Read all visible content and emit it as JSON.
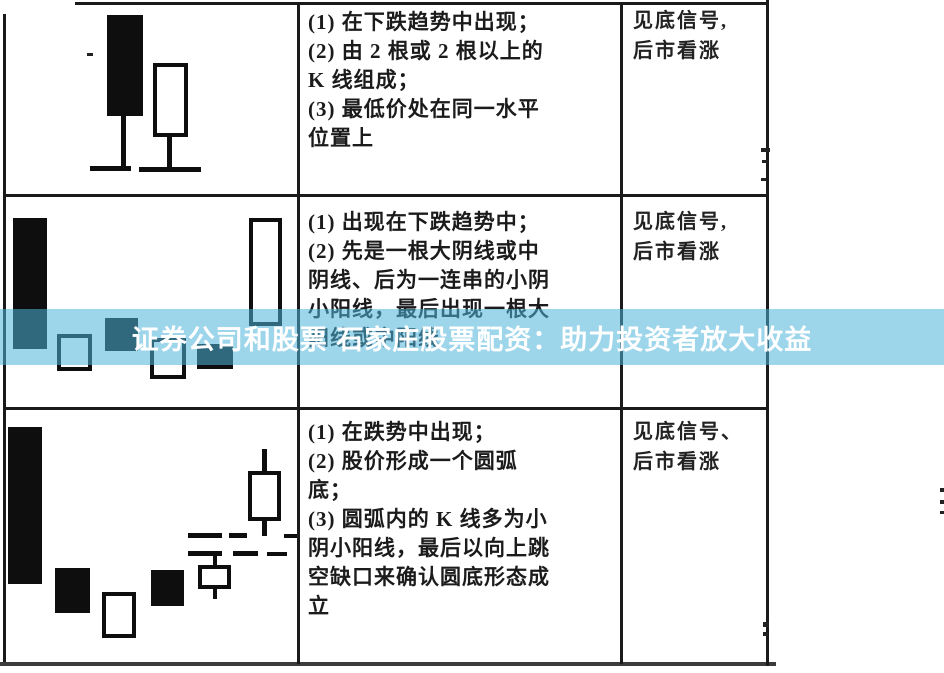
{
  "banner": {
    "text": "证券公司和股票 石家庄股票配资：助力投资者放大收益",
    "background": "rgba(77,178,218,0.55)",
    "color": "#ffffff"
  },
  "table": {
    "columns": [
      "pattern-drawing",
      "pattern-description",
      "signal"
    ],
    "rows": [
      {
        "description_lines": [
          "(1) 在下跌趋势中出现；",
          "(2) 由 2 根或 2 根以上的",
          "K 线组成；",
          "(3) 最低价处在同一水平",
          "位置上"
        ],
        "signal_lines": [
          "见底信号,",
          "后市看涨"
        ]
      },
      {
        "description_lines": [
          "(1) 出现在下跌趋势中；",
          "(2) 先是一根大阴线或中",
          "阴线、后为一连串的小阴",
          "小阳线，最后出现一根大",
          "阳线或中阳线"
        ],
        "signal_lines": [
          "见底信号,",
          "后市看涨"
        ]
      },
      {
        "description_lines": [
          "(1) 在跌势中出现；",
          "(2) 股价形成一个圆弧",
          "底；",
          "(3) 圆弧内的 K 线多为小",
          "阴小阳线，最后以向上跳",
          "空缺口来确认圆底形态成",
          "立"
        ],
        "signal_lines": [
          "见底信号、",
          "后市看涨"
        ]
      }
    ]
  },
  "candle_patterns": [
    {
      "row": 1,
      "shapes": [
        {
          "name": "black-candle-body",
          "type": "filled",
          "x": 107,
          "y": 15,
          "w": 36,
          "h": 101
        },
        {
          "name": "candle-lower-wick",
          "type": "line",
          "x": 121,
          "y": 112,
          "w": 5,
          "h": 57
        },
        {
          "name": "base-level-dash",
          "type": "line",
          "x": 90,
          "y": 166,
          "w": 41,
          "h": 5
        },
        {
          "name": "white-candle-body",
          "type": "hollow",
          "x": 153,
          "y": 63,
          "w": 35,
          "h": 74
        },
        {
          "name": "candle-lower-wick",
          "type": "line",
          "x": 167,
          "y": 134,
          "w": 5,
          "h": 36
        },
        {
          "name": "base-level-dash",
          "type": "line",
          "x": 139,
          "y": 167,
          "w": 62,
          "h": 5
        }
      ]
    },
    {
      "row": 2,
      "shapes": [
        {
          "name": "black-candle-body",
          "type": "filled",
          "x": 13,
          "y": 218,
          "w": 34,
          "h": 131
        },
        {
          "name": "white-candle-body",
          "type": "hollow",
          "x": 57,
          "y": 334,
          "w": 35,
          "h": 37
        },
        {
          "name": "black-candle-body",
          "type": "filled",
          "x": 105,
          "y": 318,
          "w": 33,
          "h": 33
        },
        {
          "name": "white-candle-body",
          "type": "hollow",
          "x": 150,
          "y": 338,
          "w": 36,
          "h": 41
        },
        {
          "name": "black-candle-body",
          "type": "filled",
          "x": 197,
          "y": 344,
          "w": 36,
          "h": 25
        },
        {
          "name": "white-candle-body",
          "type": "hollow",
          "x": 249,
          "y": 218,
          "w": 33,
          "h": 108
        }
      ]
    },
    {
      "row": 3,
      "shapes": [
        {
          "name": "black-candle-body",
          "type": "filled",
          "x": 8,
          "y": 427,
          "w": 34,
          "h": 157
        },
        {
          "name": "black-candle-body",
          "type": "filled",
          "x": 55,
          "y": 568,
          "w": 35,
          "h": 45
        },
        {
          "name": "white-candle-body",
          "type": "hollow",
          "x": 102,
          "y": 592,
          "w": 34,
          "h": 46
        },
        {
          "name": "black-candle-body",
          "type": "filled",
          "x": 151,
          "y": 570,
          "w": 33,
          "h": 36
        },
        {
          "name": "candle-upper-wick",
          "type": "line",
          "x": 213,
          "y": 551,
          "w": 4,
          "h": 15
        },
        {
          "name": "white-candle-body",
          "type": "hollow",
          "x": 198,
          "y": 565,
          "w": 33,
          "h": 24
        },
        {
          "name": "candle-lower-wick",
          "type": "line",
          "x": 213,
          "y": 589,
          "w": 4,
          "h": 10
        },
        {
          "name": "candle-upper-wick",
          "type": "line",
          "x": 262,
          "y": 449,
          "w": 5,
          "h": 23
        },
        {
          "name": "white-candle-body",
          "type": "hollow",
          "x": 248,
          "y": 471,
          "w": 33,
          "h": 50
        },
        {
          "name": "candle-lower-wick",
          "type": "line",
          "x": 262,
          "y": 521,
          "w": 5,
          "h": 15
        },
        {
          "name": "gap-dash",
          "type": "line",
          "x": 188,
          "y": 533,
          "w": 34,
          "h": 5
        },
        {
          "name": "gap-dash",
          "type": "line",
          "x": 229,
          "y": 533,
          "w": 18,
          "h": 5
        },
        {
          "name": "gap-dash",
          "type": "line",
          "x": 284,
          "y": 534,
          "w": 13,
          "h": 4
        },
        {
          "name": "gap-dash",
          "type": "line",
          "x": 188,
          "y": 551,
          "w": 34,
          "h": 5
        },
        {
          "name": "gap-dash",
          "type": "line",
          "x": 233,
          "y": 551,
          "w": 25,
          "h": 5
        },
        {
          "name": "gap-dash",
          "type": "line",
          "x": 267,
          "y": 552,
          "w": 20,
          "h": 4
        }
      ]
    }
  ],
  "scan_artifacts": [
    {
      "x": 87,
      "y": 53,
      "w": 6,
      "h": 3
    },
    {
      "x": 761,
      "y": 148,
      "w": 9,
      "h": 4
    },
    {
      "x": 762,
      "y": 160,
      "w": 6,
      "h": 3
    },
    {
      "x": 761,
      "y": 178,
      "w": 5,
      "h": 3
    },
    {
      "x": 763,
      "y": 622,
      "w": 6,
      "h": 5
    },
    {
      "x": 763,
      "y": 632,
      "w": 5,
      "h": 4
    },
    {
      "x": 940,
      "y": 488,
      "w": 4,
      "h": 4
    },
    {
      "x": 940,
      "y": 500,
      "w": 4,
      "h": 4
    },
    {
      "x": 940,
      "y": 511,
      "w": 4,
      "h": 3
    }
  ]
}
